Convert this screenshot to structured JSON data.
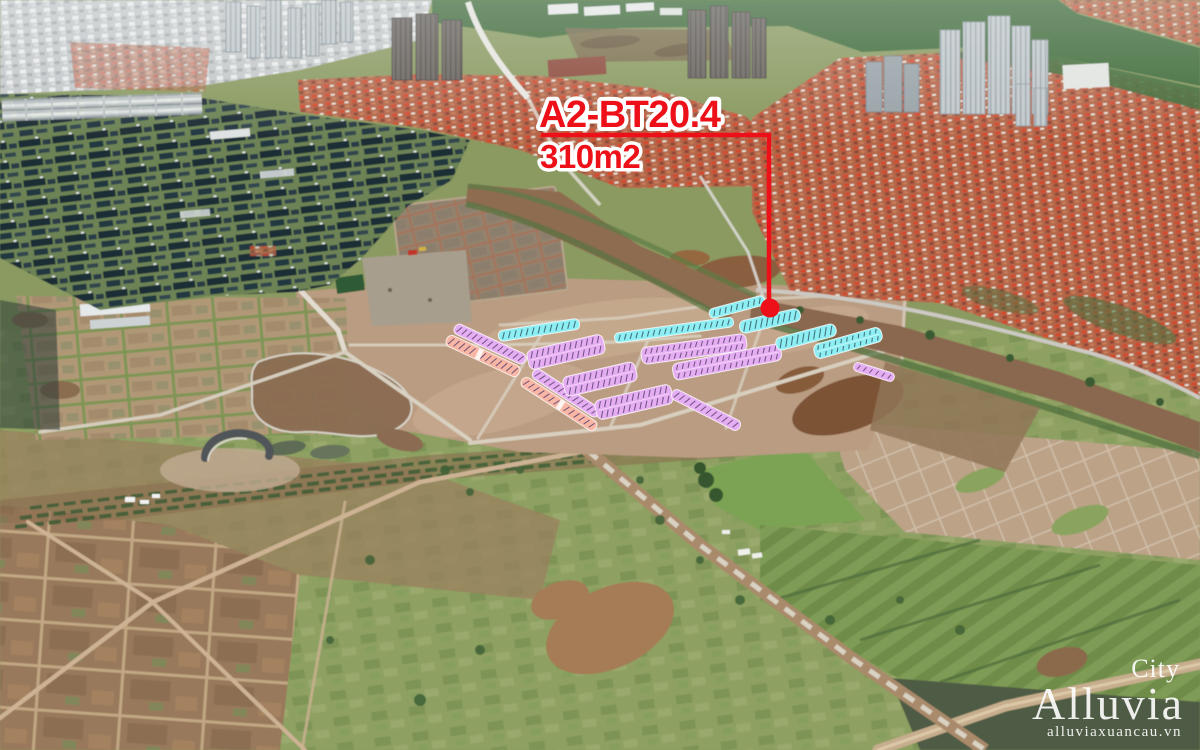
{
  "callout": {
    "plot_label": "A2-BT20.4",
    "plot_area": "310m2",
    "color": "#ee1018",
    "line": {
      "x1": 541,
      "y": 135,
      "corner_x": 769,
      "y2": 300
    },
    "dot": {
      "x": 770,
      "y": 308,
      "r": 9.5
    }
  },
  "watermark": {
    "top": "City",
    "brand": "Alluvia",
    "website": "alluviaxuancau.vn",
    "color": "#ffffff"
  },
  "plot_colors": {
    "cyan": "#8deef3",
    "violet": "#e6aef2",
    "salmon": "#f8b7a5",
    "tick_cyan": "#2f5560",
    "tick_violet": "#5a3f6e",
    "outline": "rgba(255,255,255,0.75)"
  },
  "plots": [
    {
      "id": "S1",
      "c": "salmon",
      "cx": 483,
      "cy": 356,
      "l": 80,
      "w": 12,
      "a": 25,
      "rows": 1,
      "gap": 0.45
    },
    {
      "id": "V1",
      "c": "violet",
      "cx": 490,
      "cy": 344,
      "l": 78,
      "w": 11,
      "a": 25,
      "rows": 1
    },
    {
      "id": "S2",
      "c": "salmon",
      "cx": 559,
      "cy": 404,
      "l": 88,
      "w": 11,
      "a": 33,
      "rows": 1,
      "gap": 0.52
    },
    {
      "id": "V2",
      "c": "violet",
      "cx": 566,
      "cy": 393,
      "l": 78,
      "w": 11,
      "a": 33,
      "rows": 1
    },
    {
      "id": "V3",
      "c": "violet",
      "cx": 566,
      "cy": 352,
      "l": 78,
      "w": 20,
      "a": -13,
      "rows": 2
    },
    {
      "id": "V4",
      "c": "violet",
      "cx": 600,
      "cy": 379,
      "l": 74,
      "w": 20,
      "a": -13,
      "rows": 2
    },
    {
      "id": "V5",
      "c": "violet",
      "cx": 634,
      "cy": 402,
      "l": 78,
      "w": 20,
      "a": -13,
      "rows": 2
    },
    {
      "id": "P1",
      "c": "violet",
      "cx": 694,
      "cy": 349,
      "l": 106,
      "w": 17,
      "a": -8,
      "rows": 2
    },
    {
      "id": "P2",
      "c": "violet",
      "cx": 727,
      "cy": 362,
      "l": 110,
      "w": 17,
      "a": -11,
      "rows": 2
    },
    {
      "id": "V7",
      "c": "violet",
      "cx": 706,
      "cy": 410,
      "l": 76,
      "w": 11,
      "a": 27,
      "rows": 1
    },
    {
      "id": "V8",
      "c": "violet",
      "cx": 874,
      "cy": 372,
      "l": 42,
      "w": 9,
      "a": 17,
      "rows": 1
    },
    {
      "id": "C1",
      "c": "cyan",
      "cx": 539,
      "cy": 330,
      "l": 82,
      "w": 11,
      "a": -9,
      "rows": 1
    },
    {
      "id": "C2",
      "c": "cyan",
      "cx": 674,
      "cy": 330,
      "l": 120,
      "w": 10,
      "a": -8,
      "rows": 1
    },
    {
      "id": "C3",
      "c": "cyan",
      "cx": 737,
      "cy": 307,
      "l": 57,
      "w": 10,
      "a": -15,
      "rows": 1
    },
    {
      "id": "C4",
      "c": "cyan",
      "cx": 770,
      "cy": 321,
      "l": 62,
      "w": 13,
      "a": -13,
      "rows": 1
    },
    {
      "id": "C5",
      "c": "cyan",
      "cx": 806,
      "cy": 337,
      "l": 62,
      "w": 13,
      "a": -15,
      "rows": 1
    },
    {
      "id": "C6",
      "c": "cyan",
      "cx": 848,
      "cy": 343,
      "l": 70,
      "w": 15,
      "a": -16,
      "rows": 2
    }
  ]
}
